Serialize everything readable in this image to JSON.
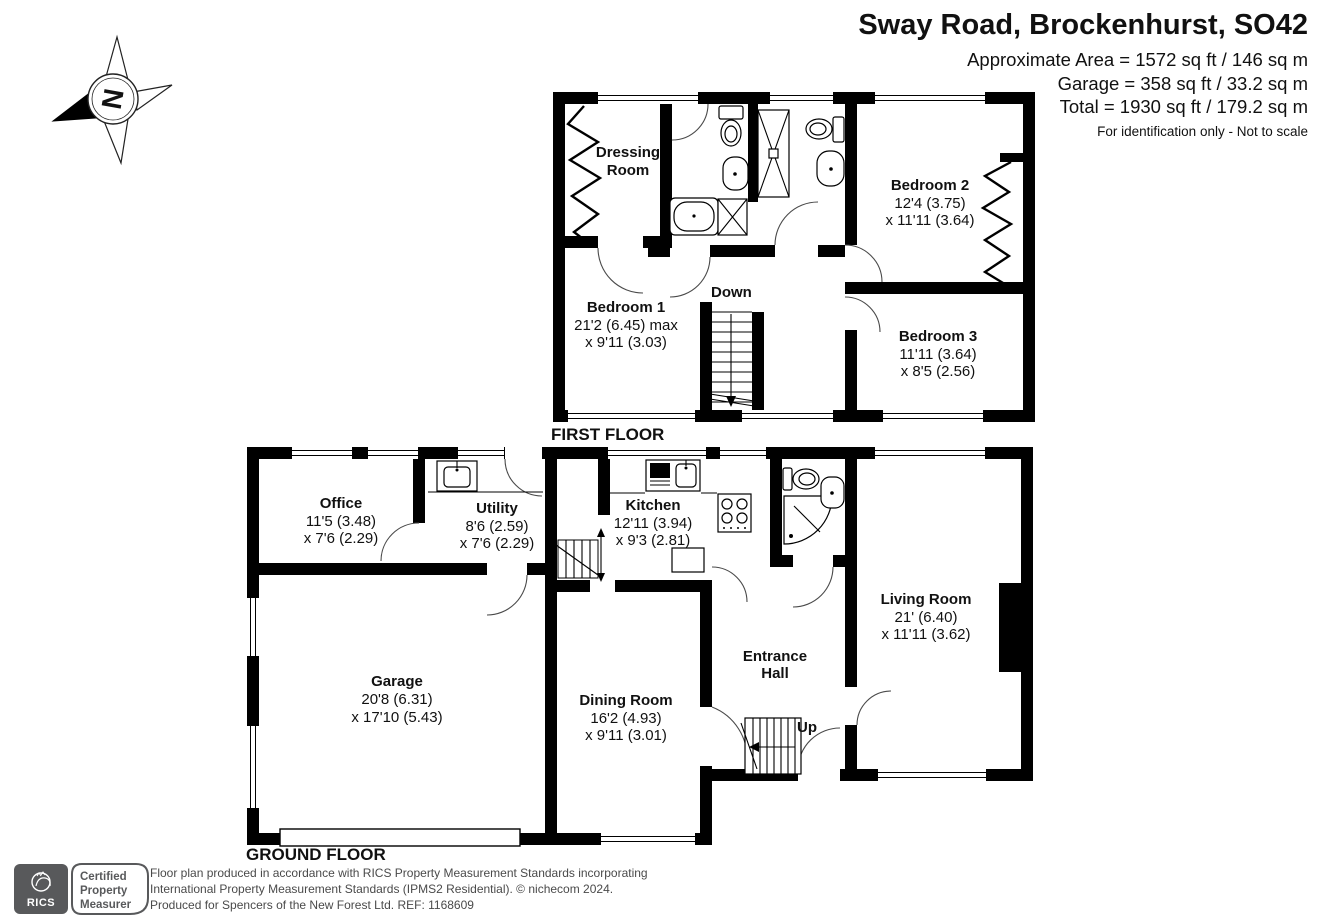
{
  "header": {
    "title": "Sway Road, Brockenhurst, SO42",
    "area_line1": "Approximate Area = 1572 sq ft / 146 sq m",
    "area_line2": "Garage = 358 sq ft / 33.2 sq m",
    "area_line3": "Total = 1930 sq ft / 179.2 sq m",
    "disclaimer": "For identification only - Not to scale"
  },
  "compass": {
    "north_letter": "N"
  },
  "first_floor": {
    "label": "FIRST FLOOR",
    "stairs_label": "Down",
    "rooms": {
      "dressing": {
        "name_line1": "Dressing",
        "name_line2": "Room"
      },
      "bedroom1": {
        "name": "Bedroom 1",
        "dim1": "21'2 (6.45) max",
        "dim2": "x 9'11 (3.03)"
      },
      "bedroom2": {
        "name": "Bedroom 2",
        "dim1": "12'4 (3.75)",
        "dim2": "x 11'11 (3.64)"
      },
      "bedroom3": {
        "name": "Bedroom 3",
        "dim1": "11'11 (3.64)",
        "dim2": "x 8'5 (2.56)"
      }
    }
  },
  "ground_floor": {
    "label": "GROUND FLOOR",
    "stairs_label": "Up",
    "rooms": {
      "office": {
        "name": "Office",
        "dim1": "11'5 (3.48)",
        "dim2": "x 7'6 (2.29)"
      },
      "utility": {
        "name": "Utility",
        "dim1": "8'6 (2.59)",
        "dim2": "x 7'6 (2.29)"
      },
      "kitchen": {
        "name": "Kitchen",
        "dim1": "12'11 (3.94)",
        "dim2": "x 9'3 (2.81)"
      },
      "garage": {
        "name": "Garage",
        "dim1": "20'8 (6.31)",
        "dim2": "x 17'10 (5.43)"
      },
      "dining": {
        "name": "Dining Room",
        "dim1": "16'2 (4.93)",
        "dim2": "x 9'11 (3.01)"
      },
      "entrance": {
        "name_line1": "Entrance",
        "name_line2": "Hall"
      },
      "living": {
        "name": "Living Room",
        "dim1": "21' (6.40)",
        "dim2": "x 11'11 (3.62)"
      }
    }
  },
  "footer": {
    "badge": {
      "brand": "RICS",
      "line1": "Certified",
      "line2": "Property",
      "line3": "Measurer"
    },
    "line1": "Floor plan produced in accordance with RICS Property Measurement Standards incorporating",
    "line2": "International Property Measurement Standards (IPMS2 Residential).   © nichecom 2024.",
    "line3": "Produced for Spencers of the New Forest Ltd.   REF:  1168609"
  },
  "colors": {
    "wall": "#000000",
    "accent_gray": "#58595b",
    "footer_text": "#4a4a4a"
  }
}
